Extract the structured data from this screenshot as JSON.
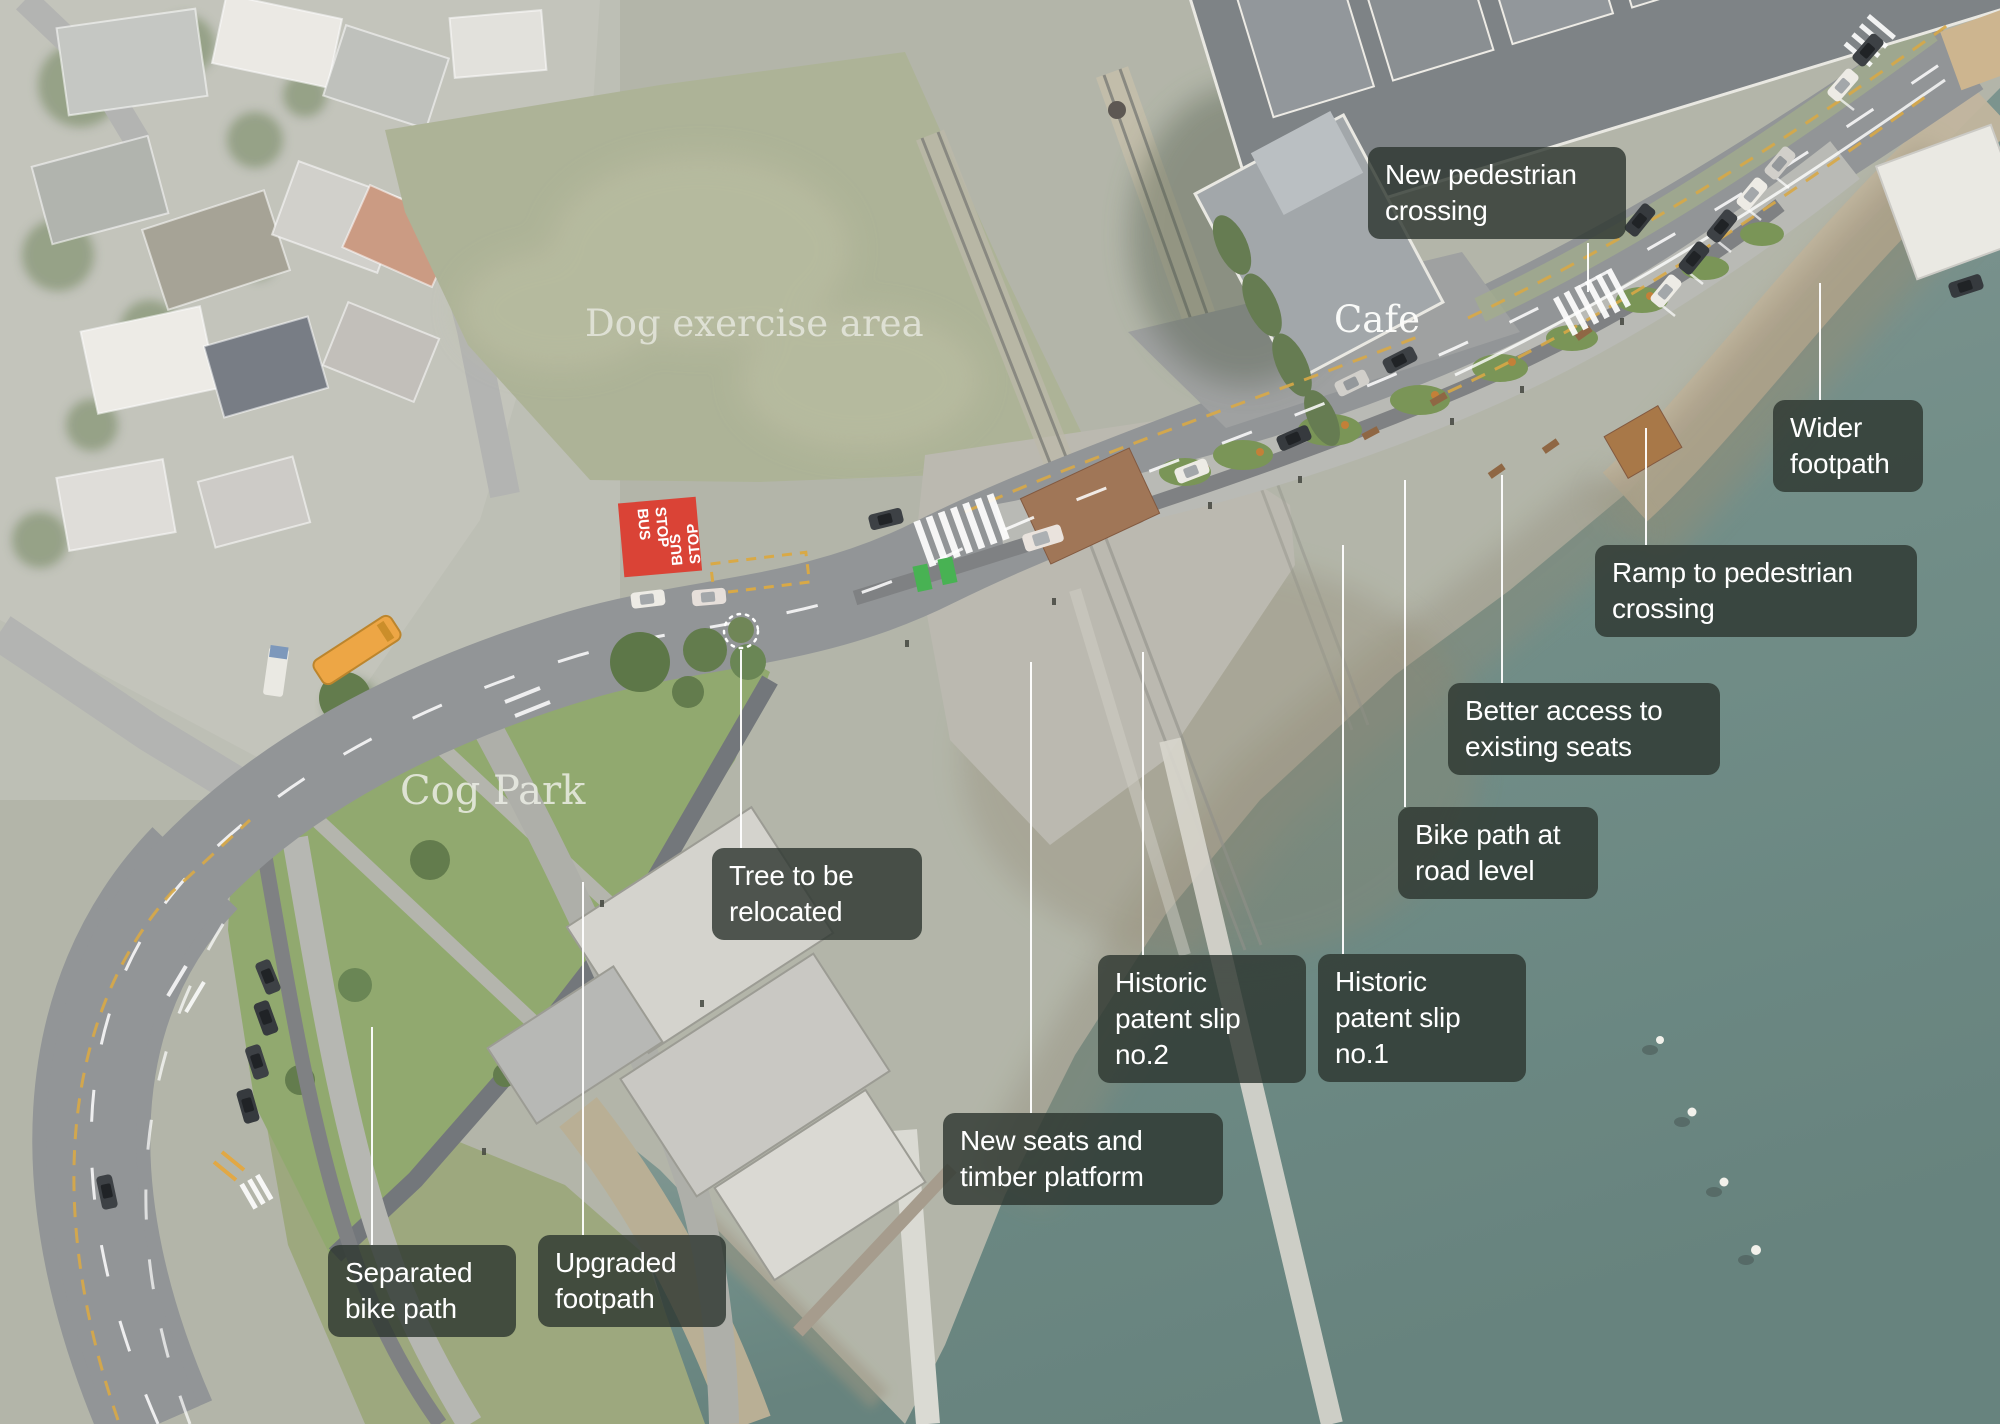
{
  "place_labels": {
    "dog_area": "Dog exercise area",
    "cog_park": "Cog Park",
    "cafe": "Cafe"
  },
  "annotations": [
    {
      "id": "new-pedestrian-crossing",
      "label": "New pedestrian crossing"
    },
    {
      "id": "wider-footpath",
      "label": "Wider footpath"
    },
    {
      "id": "ramp-to-pedestrian-crossing",
      "label": "Ramp to pedestrian crossing"
    },
    {
      "id": "better-access-to-existing-seats",
      "label": "Better access to existing seats"
    },
    {
      "id": "bike-path-at-road-level",
      "label": "Bike path at road level"
    },
    {
      "id": "historic-patent-slip-no2",
      "label": "Historic patent slip no.2"
    },
    {
      "id": "historic-patent-slip-no1",
      "label": "Historic patent slip no.1"
    },
    {
      "id": "new-seats-and-timber-platform",
      "label": "New seats and timber platform"
    },
    {
      "id": "tree-to-be-relocated",
      "label": "Tree to be relocated"
    },
    {
      "id": "upgraded-footpath",
      "label": "Upgraded footpath"
    },
    {
      "id": "separated-bike-path",
      "label": "Separated bike path"
    }
  ],
  "bus_stop": {
    "line1": "BUS",
    "line2": "STOP"
  },
  "colors": {
    "label_bg": "rgba(44,53,46,0.8)",
    "label_text": "#ffffff",
    "leader": "#ffffff",
    "water": "#6b8781",
    "park_grass": "#8ca568",
    "field_grass": "#a9af92",
    "road": "#8d9092",
    "bus_stop_red": "#d8392c",
    "bus_orange": "#eda23c",
    "bike_box_green": "#3fae4a",
    "marking_yellow": "#d7a53d"
  }
}
